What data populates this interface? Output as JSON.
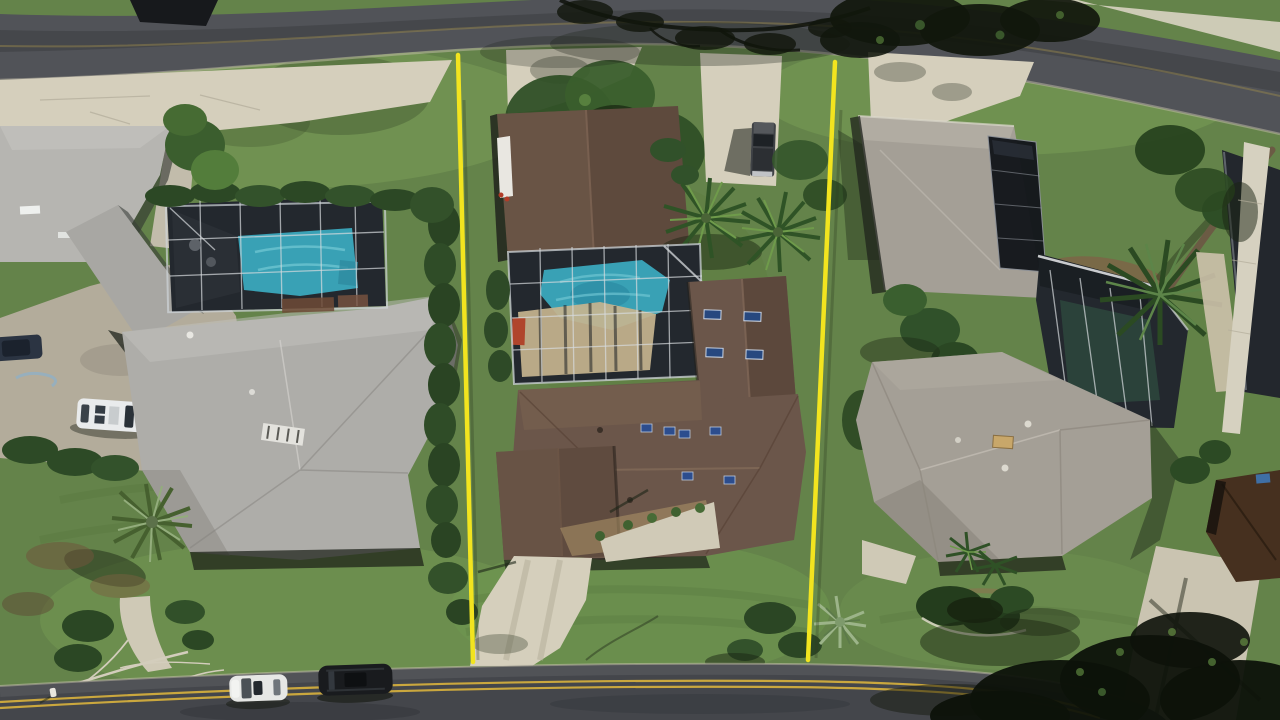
{
  "scene": {
    "image_type": "aerial-drone-photograph",
    "description": "Overhead aerial view of three suburban Florida homes between two curved streets; the center lot with brown roof and screened pool is marked off by two bright yellow property boundary lines.",
    "palette": {
      "grass": "#64834a",
      "grass_light": "#7ca057",
      "grass_dark": "#47642f",
      "asphalt": "#515358",
      "asphalt_dark": "#44464b",
      "concrete": "#d5cfbc",
      "concrete_dim": "#b3ac9b",
      "sidewalk": "#d6d1c0",
      "pool_teal": "#39a1b5",
      "pool_teal_light": "#72c8d4",
      "roof_gray": "#b6b5b1",
      "roof_brown": "#6b564a",
      "roof_brown_dark": "#5e4a3d",
      "roof_granite": "#a49f96",
      "screen_dark": "#23282e",
      "solar_panel": "#14171c",
      "boundary_yellow": "#f2e41f",
      "road_line_yellow": "#caa73e",
      "canopy_dark": "#11170c",
      "shadow_green": "#1b2513"
    },
    "objects": [
      {
        "label": "Curved street along the top"
      },
      {
        "label": "Residential street with double yellow center line (bottom)"
      },
      {
        "label": "Left home - gray hip roof with courtyard and screened pool"
      },
      {
        "label": "Center home - brown roof, screened pool, lot marked by yellow lines"
      },
      {
        "label": "Right home - gray roof with rooftop solar panels and pool cage"
      },
      {
        "label": "Yellow property boundary line (left)"
      },
      {
        "label": "Yellow property boundary line (right)"
      },
      {
        "label": "Screened swimming pool of left home"
      },
      {
        "label": "Screened swimming pool of center home"
      },
      {
        "label": "Glass pool cage of right home"
      },
      {
        "label": "Rooftop solar panel array"
      },
      {
        "label": "White van parked in courtyard"
      },
      {
        "label": "Pickup truck on driveway"
      },
      {
        "label": "White car parked on street"
      },
      {
        "label": "Black SUV parked on street"
      },
      {
        "label": "Palm trees and tropical landscaping"
      },
      {
        "label": "Fallen bare branches near bottom left"
      }
    ]
  }
}
